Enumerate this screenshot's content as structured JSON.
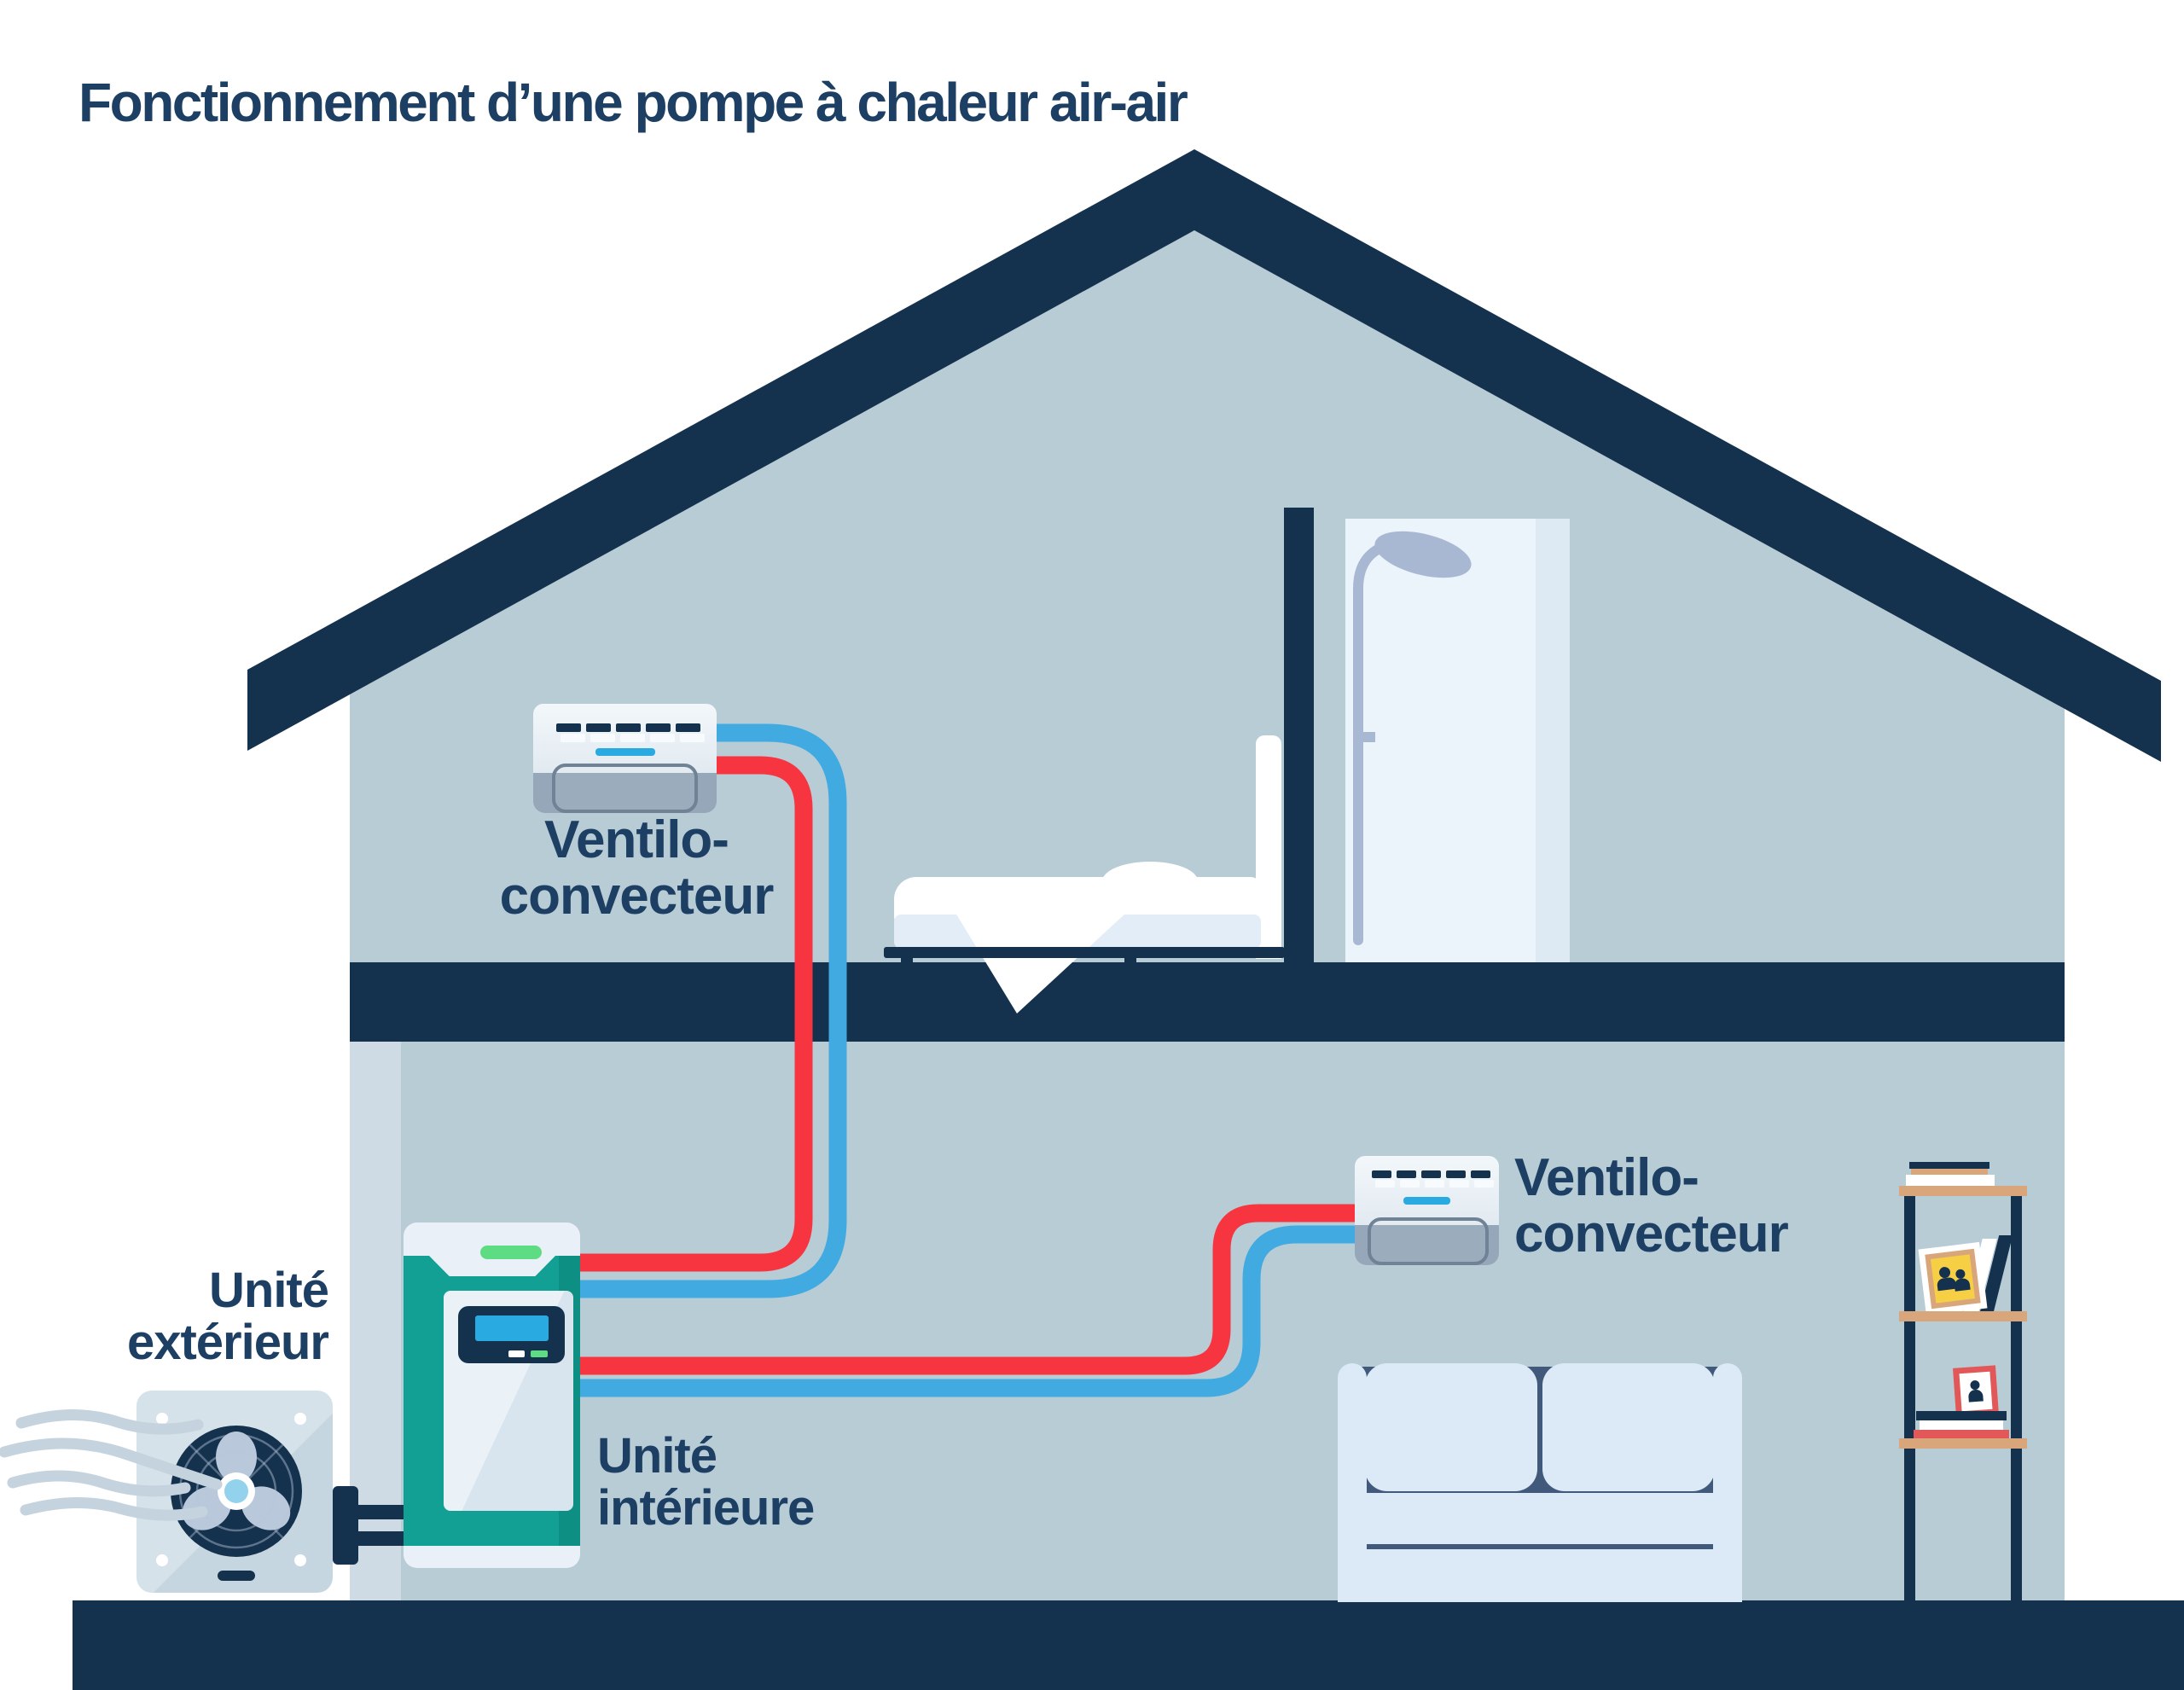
{
  "title": "Fonctionnement d’une pompe à chaleur air-air",
  "labels": {
    "ventilo_upper": {
      "line1": "Ventilo-",
      "line2": "convecteur"
    },
    "ventilo_lower": {
      "line1": "Ventilo-",
      "line2": "convecteur"
    },
    "outdoor_unit": {
      "line1": "Unité",
      "line2": "extérieur"
    },
    "indoor_unit": {
      "line1": "Unité",
      "line2": "intérieure"
    }
  },
  "colors": {
    "navy": "#14314e",
    "textnavy": "#1c3f63",
    "interior": "#b8ccd6",
    "wall": "#cfdbe4",
    "pipered": "#f63540",
    "pipeblue": "#41aae1",
    "accent": "#29abe2",
    "teal": "#12a094",
    "led": "#5edc83",
    "unitgray": "#95a7b9",
    "pale": "#dce9f7",
    "sofadark": "#41597a",
    "tan": "#d9a67c",
    "bookred": "#e25757",
    "photoyellow": "#f6cf45",
    "fixture": "#a9b8d2",
    "wind": "#c5d3df",
    "fancore": "#92d2ec"
  }
}
